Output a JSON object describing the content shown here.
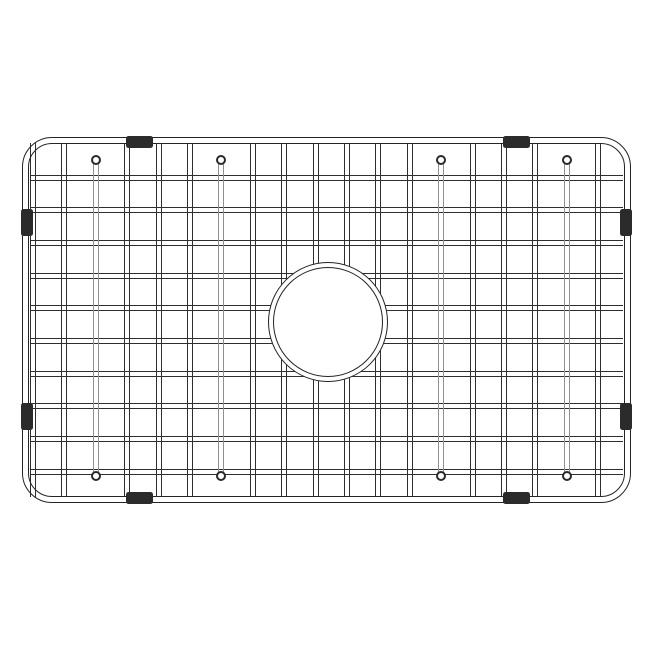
{
  "illustration": {
    "subject": "sink-bottom-grid-line-drawing",
    "canvas": {
      "width": 650,
      "height": 650,
      "background": "#ffffff"
    },
    "colors": {
      "wire_line": "#2e2e2e",
      "frame_line": "#242424",
      "leg_line": "#8f8f8f",
      "ball_line": "#2a2a2a",
      "bumper": "#2b2b2b",
      "background": "#ffffff"
    },
    "frame": {
      "left": 22,
      "top": 137,
      "width": 609,
      "height": 366,
      "outer_radius": 30,
      "inner_inset": 6,
      "inner_radius": 24,
      "outer_line_width": 1.6,
      "inner_line_width": 1.3
    },
    "grid": {
      "wire_width": 6,
      "line_width": 1.3,
      "vertical_wires_x": [
        33,
        64.4,
        127.2,
        158.6,
        190,
        252.8,
        284.2,
        315.6,
        347,
        378.4,
        409.8,
        472.6,
        504,
        535.4,
        598.2
      ],
      "horizontal_wires_y": [
        177.5,
        210.2,
        242.9,
        275.6,
        308.3,
        341,
        373.7,
        406.4,
        439.1,
        471.8
      ]
    },
    "legs": {
      "x": [
        95.8,
        221.4,
        441.2,
        566.8
      ],
      "wire_top": 160,
      "wire_bottom": 476,
      "ball_top_cy": 160,
      "ball_bottom_cy": 476,
      "ball_diameter": 10,
      "ball_line_width": 2.6
    },
    "drain": {
      "cx": 328,
      "cy": 322,
      "outer_r": 60,
      "inner_r": 55,
      "outer_line_width": 1.6,
      "inner_line_width": 1.3
    },
    "bumpers": [
      {
        "name": "bumper-top-left",
        "x": 126,
        "y": 136,
        "w": 27,
        "h": 12
      },
      {
        "name": "bumper-top-right",
        "x": 503,
        "y": 136,
        "w": 27,
        "h": 12
      },
      {
        "name": "bumper-bottom-left",
        "x": 126,
        "y": 492,
        "w": 27,
        "h": 12
      },
      {
        "name": "bumper-bottom-right",
        "x": 503,
        "y": 492,
        "w": 27,
        "h": 12
      },
      {
        "name": "bumper-left-upper",
        "x": 21,
        "y": 209,
        "w": 12,
        "h": 27
      },
      {
        "name": "bumper-left-lower",
        "x": 21,
        "y": 403,
        "w": 12,
        "h": 27
      },
      {
        "name": "bumper-right-upper",
        "x": 620,
        "y": 209,
        "w": 12,
        "h": 27
      },
      {
        "name": "bumper-right-lower",
        "x": 620,
        "y": 403,
        "w": 12,
        "h": 27
      }
    ]
  }
}
